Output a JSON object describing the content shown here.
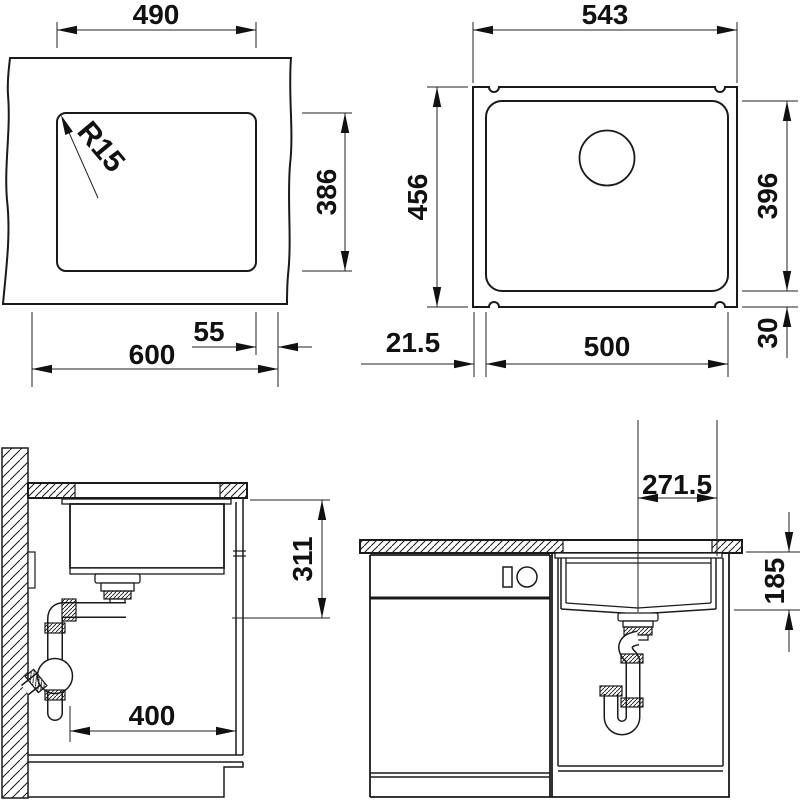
{
  "drawing": {
    "kind": "sink-installation-technical-drawing",
    "line_color": "#1a1a1a",
    "background": "#ffffff"
  },
  "views": {
    "cutout": {
      "title": "countertop cutout top view",
      "dims": {
        "cutout_width": "490",
        "corner_radius": "R15",
        "cutout_depth": "386",
        "edge_offset": "55",
        "total_width": "600"
      }
    },
    "top": {
      "title": "sink top view",
      "dims": {
        "outer_width": "543",
        "outer_depth": "456",
        "bowl_depth": "396",
        "rim_offset": "21.5",
        "bowl_width": "500",
        "rim_back": "30"
      }
    },
    "side": {
      "title": "side section view",
      "dims": {
        "drain_height": "311",
        "clearance_width": "400"
      }
    },
    "front": {
      "title": "front section view",
      "dims": {
        "drain_center_offset": "271.5",
        "depth_below_top": "185"
      }
    }
  }
}
